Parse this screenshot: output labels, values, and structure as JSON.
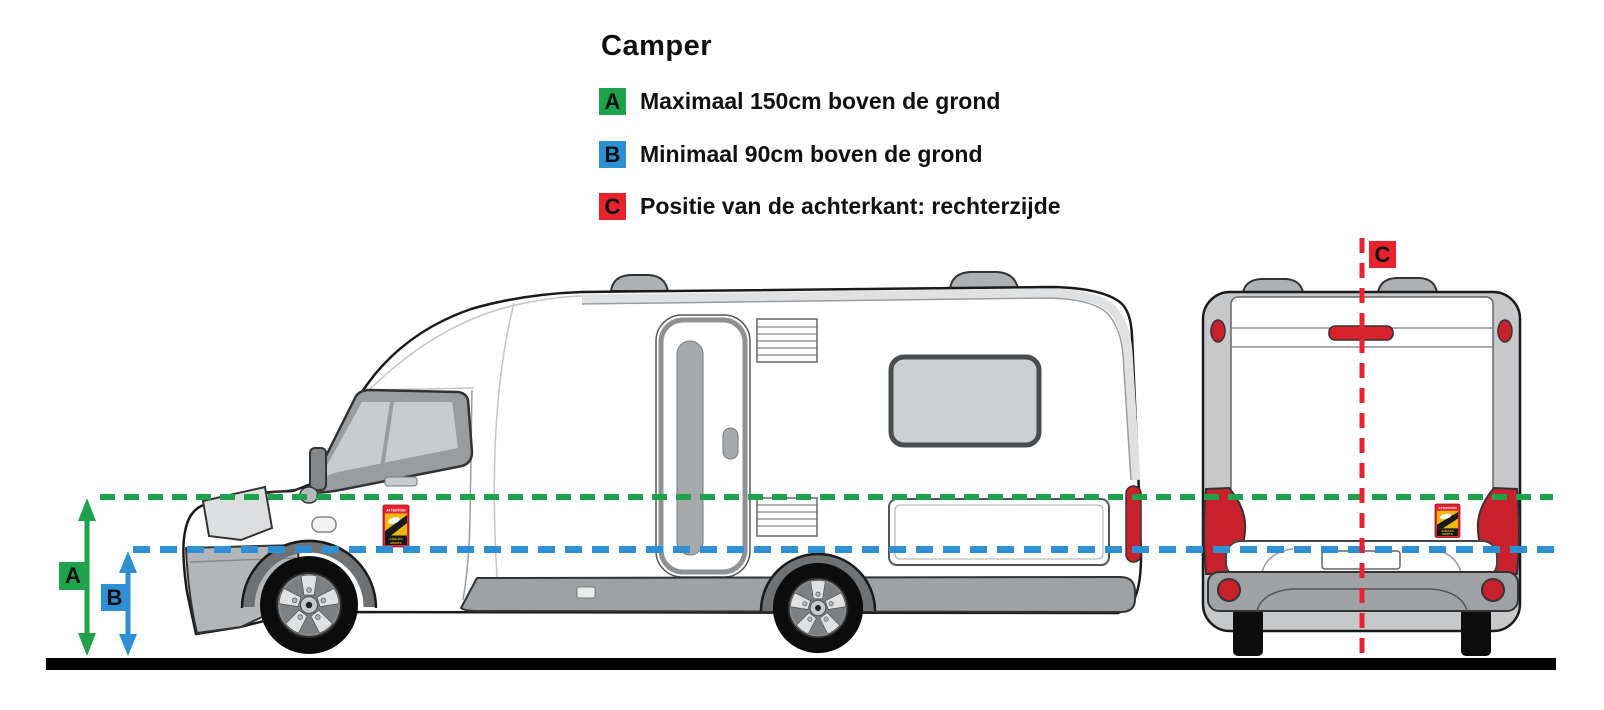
{
  "title": "Camper",
  "legend": {
    "items": [
      {
        "key": "A",
        "text": "Maximaal 150cm boven de grond"
      },
      {
        "key": "B",
        "text": "Minimaal 90cm boven de grond"
      },
      {
        "key": "C",
        "text": "Positie van de achterkant: rechterzijde"
      }
    ]
  },
  "sticker": {
    "top_text": "ATTENTION",
    "bottom_line1": "ANGLES",
    "bottom_line2": "MORTS"
  },
  "colors": {
    "green": "#1fa24c",
    "blue": "#2e8fd5",
    "red": "#e8232e",
    "tail_red": "#c9212b",
    "ink": "#1a1a1a",
    "ground_black": "#000000"
  }
}
